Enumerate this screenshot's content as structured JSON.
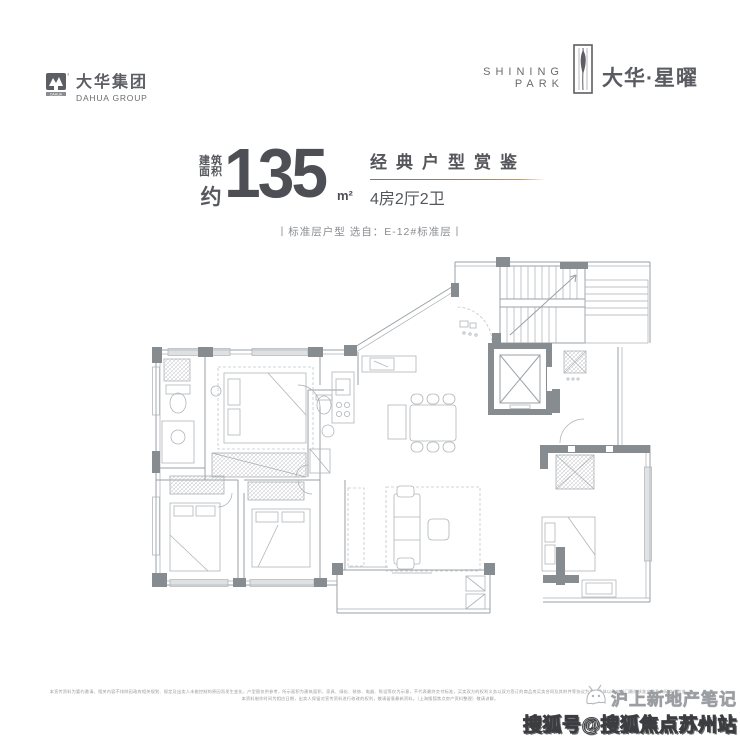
{
  "header": {
    "dahua": {
      "cn": "大华集团",
      "en": "DAHUA GROUP"
    },
    "project": {
      "en_top": "SHINING",
      "en_bottom": "PARK",
      "cn": "大华·星曜"
    }
  },
  "title": {
    "prefix_top": "建筑",
    "prefix_mid": "面积",
    "prefix_bottom": "约",
    "area": "135",
    "unit": "m²",
    "tagline": "经典户型赏鉴",
    "layout": "4房2厅2卫",
    "subtitle": "丨标准层户型  选自：E-12#标准层丨"
  },
  "floor_plan": {
    "description": "4房2厅2卫户型平面图（含楼梯间、电梯、餐厅、客厅、厨房、卫生间、阳台）"
  },
  "footer": {
    "fine_print_line1": "本宣传资料为要约邀请，相关内容不排除因政府相关规划、规定及出卖人未能控制的原因而发生变化，户型图仅供参考，所示面积为建筑面积，家具、绿化、装饰、电器、陈设等仅为示意，不代表最终交付标准，买卖双方的权利义务以双方签订的商品房买卖合同及其附件等协议为准，具体以政府部门最终核准文件及实际交付为准。",
    "fine_print_line2": "本资料制作时间为相应日期，出卖人保留对宣传资料进行修改的权利，敬请留意最新资料。（上海搜狐焦点房产资料整理）敬请谅解。",
    "watermark_title": "沪上新地产笔记",
    "watermark_badge": "搜狐号@搜狐焦点苏州站"
  },
  "colors": {
    "ink": "#4d4f54",
    "accent_gold": "#b9996b",
    "plan_line": "#9ba1a5",
    "plan_wall": "#878c90"
  }
}
